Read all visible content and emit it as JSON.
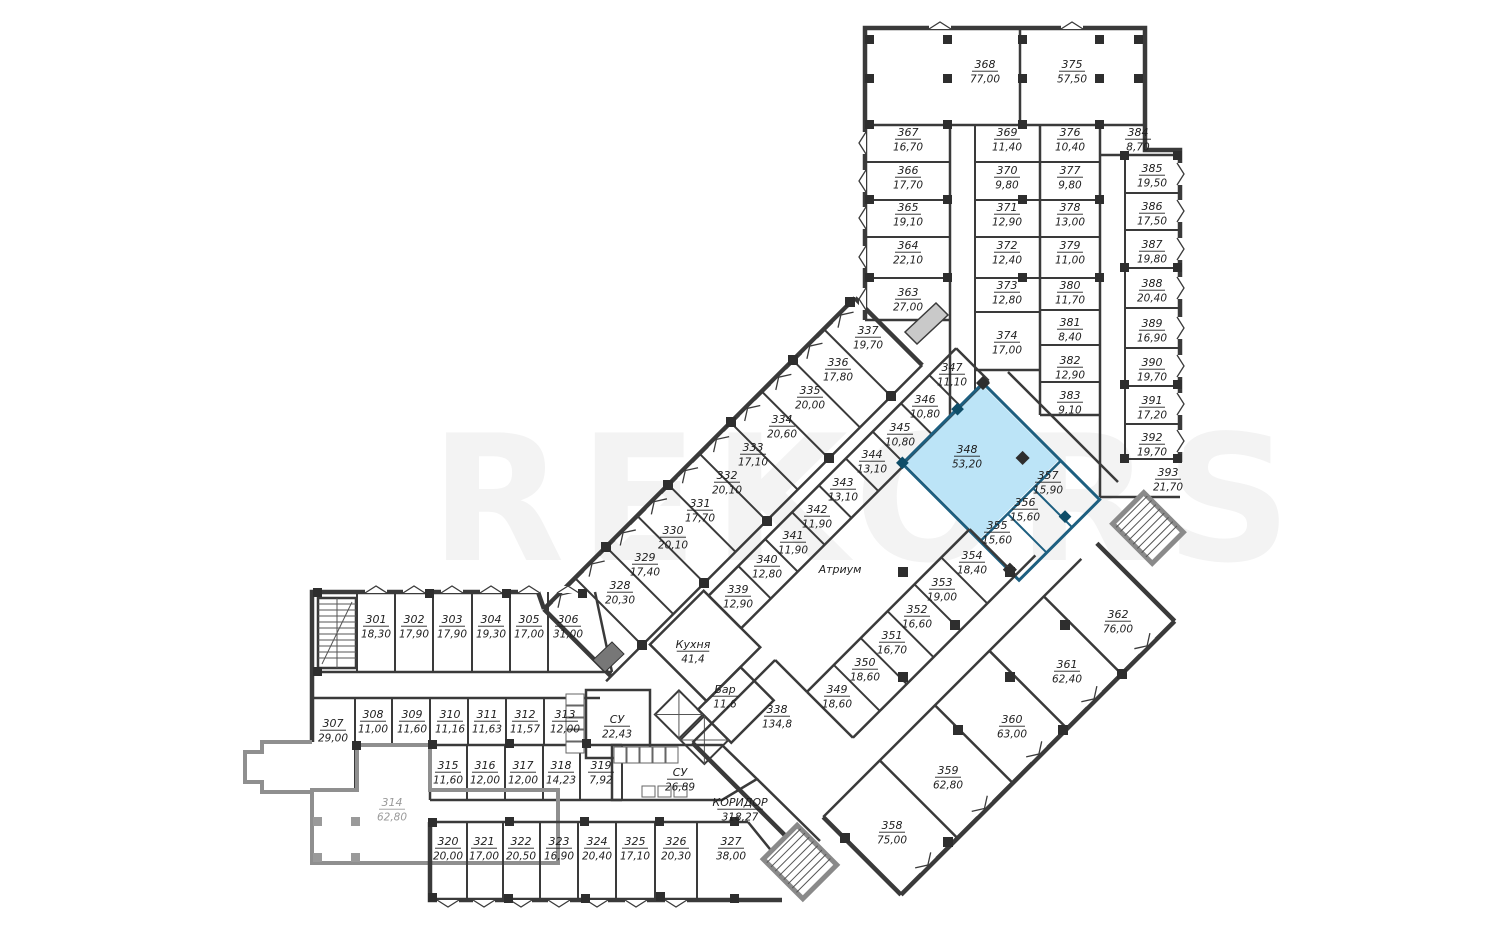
{
  "watermark": "REKORS",
  "colors": {
    "highlight_fill": "#aedcf5",
    "highlight_fill_light": "#bce4f7",
    "highlight_wall": "#1d5f80",
    "wall": "#3a3a3a",
    "muted": "#9a9a9a"
  },
  "atrium_label": "Атриум",
  "rooms": [
    {
      "n": "368",
      "a": "77,00",
      "x": 985,
      "y": 68
    },
    {
      "n": "375",
      "a": "57,50",
      "x": 1072,
      "y": 68
    },
    {
      "n": "367",
      "a": "16,70",
      "x": 908,
      "y": 136
    },
    {
      "n": "366",
      "a": "17,70",
      "x": 908,
      "y": 174
    },
    {
      "n": "365",
      "a": "19,10",
      "x": 908,
      "y": 211
    },
    {
      "n": "364",
      "a": "22,10",
      "x": 908,
      "y": 249
    },
    {
      "n": "363",
      "a": "27,00",
      "x": 908,
      "y": 296
    },
    {
      "n": "369",
      "a": "11,40",
      "x": 1007,
      "y": 136
    },
    {
      "n": "370",
      "a": "9,80",
      "x": 1007,
      "y": 174
    },
    {
      "n": "371",
      "a": "12,90",
      "x": 1007,
      "y": 211
    },
    {
      "n": "372",
      "a": "12,40",
      "x": 1007,
      "y": 249
    },
    {
      "n": "373",
      "a": "12,80",
      "x": 1007,
      "y": 289
    },
    {
      "n": "374",
      "a": "17,00",
      "x": 1007,
      "y": 339
    },
    {
      "n": "376",
      "a": "10,40",
      "x": 1070,
      "y": 136
    },
    {
      "n": "377",
      "a": "9,80",
      "x": 1070,
      "y": 174
    },
    {
      "n": "378",
      "a": "13,00",
      "x": 1070,
      "y": 211
    },
    {
      "n": "379",
      "a": "11,00",
      "x": 1070,
      "y": 249
    },
    {
      "n": "380",
      "a": "11,70",
      "x": 1070,
      "y": 289
    },
    {
      "n": "381",
      "a": "8,40",
      "x": 1070,
      "y": 326
    },
    {
      "n": "382",
      "a": "12,90",
      "x": 1070,
      "y": 364
    },
    {
      "n": "383",
      "a": "9,10",
      "x": 1070,
      "y": 399
    },
    {
      "n": "384",
      "a": "8,70",
      "x": 1138,
      "y": 136
    },
    {
      "n": "385",
      "a": "19,50",
      "x": 1152,
      "y": 172
    },
    {
      "n": "386",
      "a": "17,50",
      "x": 1152,
      "y": 210
    },
    {
      "n": "387",
      "a": "19,80",
      "x": 1152,
      "y": 248
    },
    {
      "n": "388",
      "a": "20,40",
      "x": 1152,
      "y": 287
    },
    {
      "n": "389",
      "a": "16,90",
      "x": 1152,
      "y": 327
    },
    {
      "n": "390",
      "a": "19,70",
      "x": 1152,
      "y": 366
    },
    {
      "n": "391",
      "a": "17,20",
      "x": 1152,
      "y": 404
    },
    {
      "n": "392",
      "a": "19,70",
      "x": 1152,
      "y": 441
    },
    {
      "n": "393",
      "a": "21,70",
      "x": 1168,
      "y": 476
    },
    {
      "n": "337",
      "a": "19,70",
      "x": 868,
      "y": 334
    },
    {
      "n": "336",
      "a": "17,80",
      "x": 838,
      "y": 366
    },
    {
      "n": "335",
      "a": "20,00",
      "x": 810,
      "y": 394
    },
    {
      "n": "334",
      "a": "20,60",
      "x": 782,
      "y": 423
    },
    {
      "n": "333",
      "a": "17,10",
      "x": 753,
      "y": 451
    },
    {
      "n": "332",
      "a": "20,10",
      "x": 727,
      "y": 479
    },
    {
      "n": "331",
      "a": "17,70",
      "x": 700,
      "y": 507
    },
    {
      "n": "330",
      "a": "20,10",
      "x": 673,
      "y": 534
    },
    {
      "n": "329",
      "a": "17,40",
      "x": 645,
      "y": 561
    },
    {
      "n": "328",
      "a": "20,30",
      "x": 620,
      "y": 589
    },
    {
      "n": "347",
      "a": "11,10",
      "x": 952,
      "y": 371
    },
    {
      "n": "346",
      "a": "10,80",
      "x": 925,
      "y": 403
    },
    {
      "n": "345",
      "a": "10,80",
      "x": 900,
      "y": 431
    },
    {
      "n": "344",
      "a": "13,10",
      "x": 872,
      "y": 458
    },
    {
      "n": "343",
      "a": "13,10",
      "x": 843,
      "y": 486
    },
    {
      "n": "342",
      "a": "11,90",
      "x": 817,
      "y": 513
    },
    {
      "n": "341",
      "a": "11,90",
      "x": 793,
      "y": 539
    },
    {
      "n": "340",
      "a": "12,80",
      "x": 767,
      "y": 563
    },
    {
      "n": "339",
      "a": "12,90",
      "x": 738,
      "y": 593
    },
    {
      "n": "348",
      "a": "53,20",
      "x": 967,
      "y": 453,
      "hl": 1
    },
    {
      "n": "357",
      "a": "15,90",
      "x": 1048,
      "y": 479,
      "hl": 1
    },
    {
      "n": "356",
      "a": "15,60",
      "x": 1025,
      "y": 506,
      "hl": 1
    },
    {
      "n": "355",
      "a": "15,60",
      "x": 997,
      "y": 529,
      "hl": 1
    },
    {
      "n": "354",
      "a": "18,40",
      "x": 972,
      "y": 559
    },
    {
      "n": "353",
      "a": "19,00",
      "x": 942,
      "y": 586
    },
    {
      "n": "352",
      "a": "16,60",
      "x": 917,
      "y": 613
    },
    {
      "n": "351",
      "a": "16,70",
      "x": 892,
      "y": 639
    },
    {
      "n": "350",
      "a": "18,60",
      "x": 865,
      "y": 666
    },
    {
      "n": "349",
      "a": "18,60",
      "x": 837,
      "y": 693
    },
    {
      "n": "362",
      "a": "76,00",
      "x": 1118,
      "y": 618
    },
    {
      "n": "361",
      "a": "62,40",
      "x": 1067,
      "y": 668
    },
    {
      "n": "360",
      "a": "63,00",
      "x": 1012,
      "y": 723
    },
    {
      "n": "359",
      "a": "62,80",
      "x": 948,
      "y": 774
    },
    {
      "n": "358",
      "a": "75,00",
      "x": 892,
      "y": 829
    },
    {
      "n": "338",
      "a": "134,8",
      "x": 777,
      "y": 713
    },
    {
      "n": "301",
      "a": "18,30",
      "x": 376,
      "y": 623
    },
    {
      "n": "302",
      "a": "17,90",
      "x": 414,
      "y": 623
    },
    {
      "n": "303",
      "a": "17,90",
      "x": 452,
      "y": 623
    },
    {
      "n": "304",
      "a": "19,30",
      "x": 491,
      "y": 623
    },
    {
      "n": "305",
      "a": "17,00",
      "x": 529,
      "y": 623
    },
    {
      "n": "306",
      "a": "31,00",
      "x": 568,
      "y": 623
    },
    {
      "n": "307",
      "a": "29,00",
      "x": 333,
      "y": 727
    },
    {
      "n": "308",
      "a": "11,00",
      "x": 373,
      "y": 718
    },
    {
      "n": "309",
      "a": "11,60",
      "x": 412,
      "y": 718
    },
    {
      "n": "310",
      "a": "11,16",
      "x": 450,
      "y": 718
    },
    {
      "n": "311",
      "a": "11,63",
      "x": 487,
      "y": 718
    },
    {
      "n": "312",
      "a": "11,57",
      "x": 525,
      "y": 718
    },
    {
      "n": "313",
      "a": "12,00",
      "x": 565,
      "y": 718
    },
    {
      "n": "314",
      "a": "62,80",
      "x": 392,
      "y": 806,
      "m": 1
    },
    {
      "n": "315",
      "a": "11,60",
      "x": 448,
      "y": 769
    },
    {
      "n": "316",
      "a": "12,00",
      "x": 485,
      "y": 769
    },
    {
      "n": "317",
      "a": "12,00",
      "x": 523,
      "y": 769
    },
    {
      "n": "318",
      "a": "14,23",
      "x": 561,
      "y": 769
    },
    {
      "n": "319",
      "a": "7,92",
      "x": 601,
      "y": 769
    },
    {
      "n": "320",
      "a": "20,00",
      "x": 448,
      "y": 845
    },
    {
      "n": "321",
      "a": "17,00",
      "x": 484,
      "y": 845
    },
    {
      "n": "322",
      "a": "20,50",
      "x": 521,
      "y": 845
    },
    {
      "n": "323",
      "a": "16,90",
      "x": 559,
      "y": 845
    },
    {
      "n": "324",
      "a": "20,40",
      "x": 597,
      "y": 845
    },
    {
      "n": "325",
      "a": "17,10",
      "x": 635,
      "y": 845
    },
    {
      "n": "326",
      "a": "20,30",
      "x": 676,
      "y": 845
    },
    {
      "n": "327",
      "a": "38,00",
      "x": 731,
      "y": 845
    },
    {
      "n": "СУ",
      "a": "22,43",
      "x": 617,
      "y": 723
    },
    {
      "n": "СУ",
      "a": "26,89",
      "x": 680,
      "y": 776
    },
    {
      "n": "Кухня",
      "a": "41,4",
      "x": 693,
      "y": 648
    },
    {
      "n": "Бар",
      "a": "11,6",
      "x": 725,
      "y": 693
    },
    {
      "n": "КОРИДОР",
      "a": "318,27",
      "x": 740,
      "y": 806
    },
    {
      "n": "Атриум",
      "a": "",
      "x": 840,
      "y": 573,
      "p": 1
    }
  ]
}
